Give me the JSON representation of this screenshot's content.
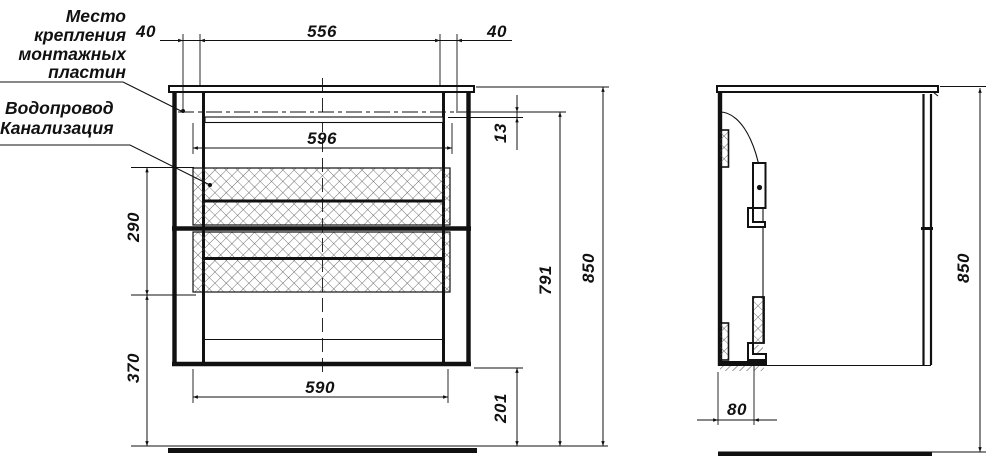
{
  "drawing": {
    "notes": {
      "mounting": [
        "Место",
        "крепления",
        "монтажных",
        "пластин"
      ],
      "utilities": [
        "Водопровод",
        "Канализация"
      ]
    },
    "front_view": {
      "top_chain_left": "40",
      "top_chain_middle": "556",
      "top_chain_right": "40",
      "inner_width": "596",
      "plate_to_rail": "13",
      "drawer_zone_height": "290",
      "lower_zone_height": "370",
      "drawer_front_width": "590",
      "bottom_clearance": "201",
      "mounting_plate_height": "791",
      "overall_height": "850"
    },
    "side_view": {
      "back_offset": "80",
      "overall_height": "850"
    },
    "colors": {
      "ink": "#111111",
      "paper": "#ffffff"
    }
  }
}
